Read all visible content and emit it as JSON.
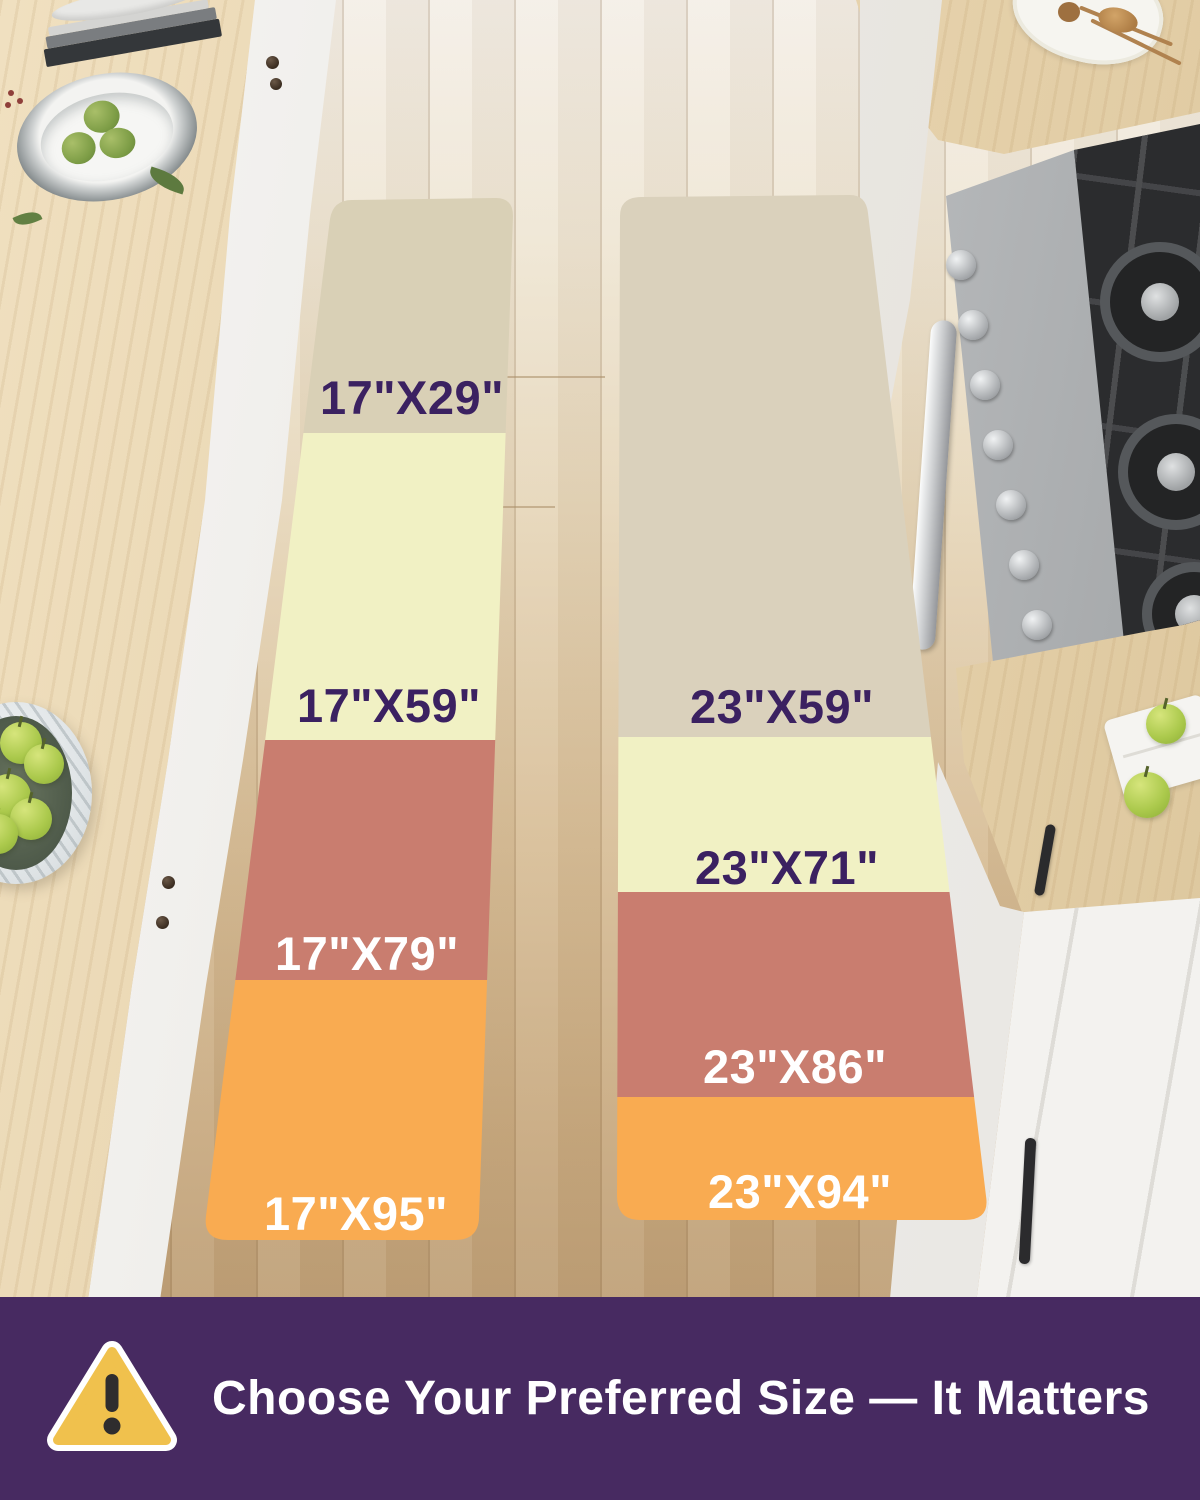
{
  "runners": {
    "left": {
      "sections": [
        {
          "label": "17\"X29\"",
          "color": "#d9d0b6",
          "label_color": "#3b2161"
        },
        {
          "label": "17\"X59\"",
          "color": "#f1f1c4",
          "label_color": "#3b2161"
        },
        {
          "label": "17\"X79\"",
          "color": "#c97d6f",
          "label_color": "#ffffff"
        },
        {
          "label": "17\"X95\"",
          "color": "#f9ab51",
          "label_color": "#ffffff"
        }
      ]
    },
    "right": {
      "sections": [
        {
          "label": "23\"X59\"",
          "color": "#dad1bc",
          "label_color": "#3b2161"
        },
        {
          "label": "23\"X71\"",
          "color": "#f1f1c4",
          "label_color": "#3b2161"
        },
        {
          "label": "23\"X86\"",
          "color": "#c97d6f",
          "label_color": "#ffffff"
        },
        {
          "label": "23\"X94\"",
          "color": "#f9ab51",
          "label_color": "#ffffff"
        }
      ]
    }
  },
  "banner": {
    "text": "Choose Your Preferred Size — It Matters",
    "background": "#472a61",
    "text_color": "#ffffff",
    "warning_icon": {
      "glyph": "!",
      "triangle_fill": "#f0c14d",
      "triangle_border": "#ffffff",
      "glyph_color": "#2f2d2e"
    }
  }
}
